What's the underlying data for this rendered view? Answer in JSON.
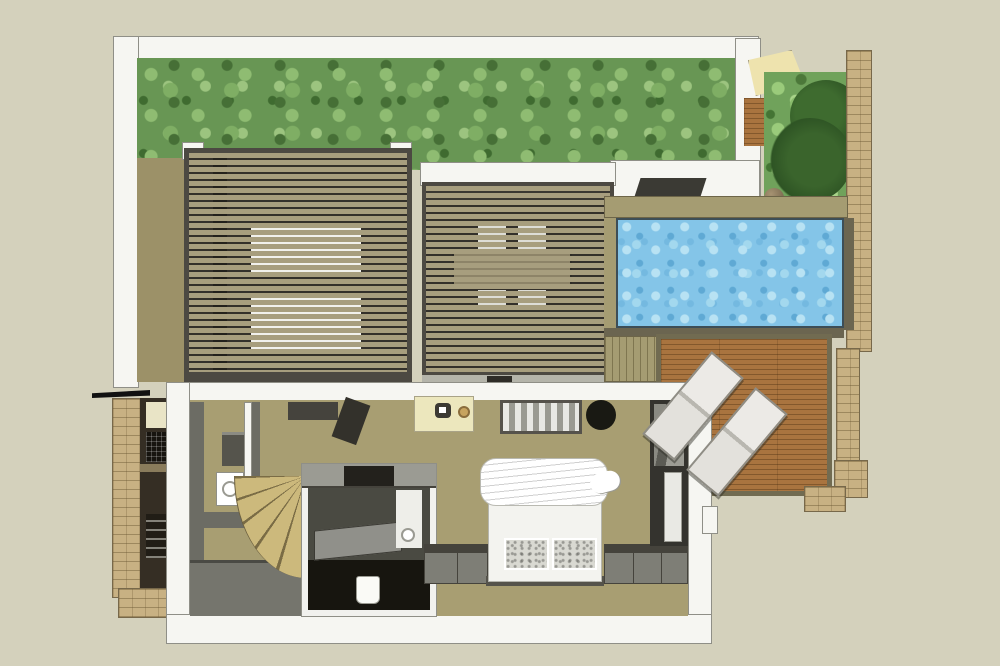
{
  "meta": {
    "kind": "architectural-floor-plan-render",
    "style": "3D cutaway plan (SketchUp-like)",
    "canvas": {
      "width_px": 1000,
      "height_px": 666
    },
    "text_visible": "none"
  },
  "palette": {
    "bg": "#d4d1bc",
    "wall-white": "#f6f6f2",
    "wall-outline": "#8f8f87",
    "foliage-base": "#689654",
    "foliage-light": "#8fbc72",
    "foliage-dark": "#466f36",
    "ground-tan": "#9c9168",
    "slat-tan": "#a79e7e",
    "slat-gap": "#33302a",
    "frame-dark": "#4c4942",
    "pool-blue": "#84c5e8",
    "pool-light": "#b8e2f3",
    "pool-dark": "#5fa9d4",
    "coping-tan": "#a59c72",
    "stone-tan": "#c8b183",
    "stone-line": "#77684a",
    "wood-deck": "#a9743f",
    "deck-border": "#716b51",
    "olive-dark": "#6b6550",
    "floor-khaki": "#a89e72",
    "interior-gray": "#6c6c64",
    "interior-darkgray": "#3b3a34",
    "near-black": "#17150f",
    "stair-tread": "#ccb97c",
    "stair-line": "#7a6c45",
    "white-furniture": "#f1f1ec",
    "desk-cream": "#ece7bd",
    "brass": "#c7a45f",
    "bush-dark": "#2e5424"
  },
  "scene": {
    "roof_level": {
      "green_roof": {
        "desc": "vegetated green roof band across the top"
      },
      "pergola_left": {
        "desc": "louvered slat roof over sleeping area",
        "mattresses_visible": 2
      },
      "pergola_middle": {
        "desc": "louvered slat roof over dining area",
        "table_visible": 1,
        "chairs_visible": 4
      },
      "skylight": {
        "desc": "dark roof opening above pool terrace"
      },
      "corner_garden": {
        "desc": "walled planting bed with shrubs and stone ball",
        "stone_sphere": 1
      }
    },
    "outdoor": {
      "pool": {
        "desc": "rectangular swimming pool with water texture"
      },
      "pool_coping": {
        "desc": "tan coping band around pool"
      },
      "deck": {
        "desc": "timber sun deck",
        "loungers": 2
      },
      "stone_walls": {
        "desc": "sandstone perimeter walls on the right edge"
      }
    },
    "interior": {
      "bedroom": {
        "bed": 1,
        "pillows": 2,
        "duvet_roll": 1,
        "bench": 1,
        "round_pouf": 1,
        "wardrobe": 1,
        "low_cabinets": 2
      },
      "work_area": {
        "desk": 1,
        "chair": 1,
        "side_table": 1
      },
      "bathroom_pod": {
        "desc": "cut-away white pod with WC and washbasin",
        "toilet": 1
      },
      "spiral_staircase": {
        "desc": "fan of timber treads"
      },
      "outdoor_closet": {
        "desc": "dark storage niche behind brick wall with shelving"
      }
    }
  }
}
